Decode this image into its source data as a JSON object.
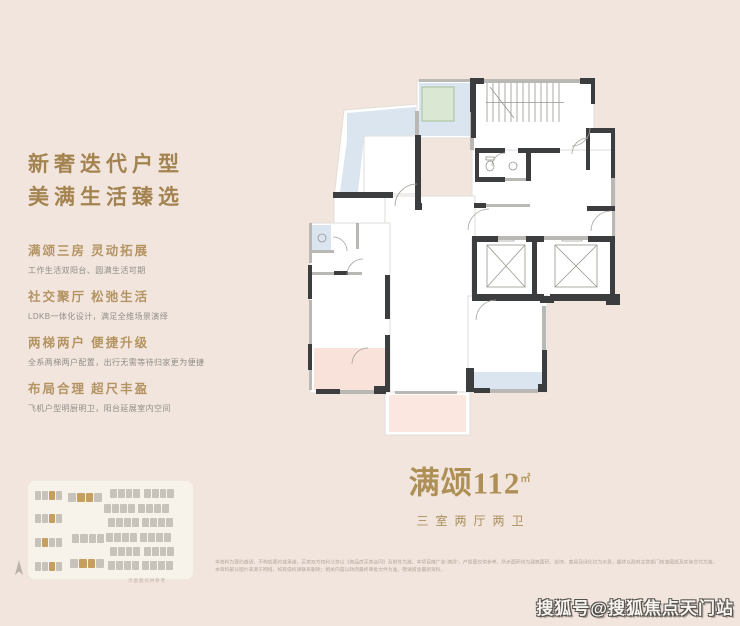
{
  "colors": {
    "background": "#f2e5dd",
    "accent_gold": "#a3834f",
    "heading_gold": "#b49463",
    "body_gray": "#8f8e89",
    "plan_wall_dark": "#3b3d3e",
    "plan_wall_gray": "#b9b8b5",
    "plan_balcony_blue": "#dbe5f0",
    "plan_equipment_green": "#dae8d3",
    "plan_bedroom_pink": "#f9e2da",
    "building_gray": "#c7c3ba",
    "building_gold": "#c59e60"
  },
  "left_panel": {
    "title_line1": "新奢迭代户型",
    "title_line2": "美满生活臻选",
    "sections": [
      {
        "heading": "满颂三房 灵动拓展",
        "body": "工作生活双阳台、圆满生活可期"
      },
      {
        "heading": "社交聚厅 松弛生活",
        "body": "LDKB一体化设计，满足全维场景演绎"
      },
      {
        "heading": "两梯两户 便捷升级",
        "body": "全系两梯两户配置，出行无需等待归家更为便捷"
      },
      {
        "heading": "布局合理 超尺丰盈",
        "body": "飞机户型明厨明卫，阳台延展室内空间"
      }
    ]
  },
  "unit_label": {
    "name": "满颂112",
    "unit": "㎡",
    "spec": "三室两厅两卫"
  },
  "site_plan": {
    "caption": "示意图仅供参考",
    "buildings": [
      {
        "x": 7,
        "y": 10,
        "w": 27,
        "gold": [
          2
        ]
      },
      {
        "x": 40,
        "y": 12,
        "w": 34,
        "gold": [
          1,
          2
        ]
      },
      {
        "x": 82,
        "y": 8,
        "w": 30,
        "gold": []
      },
      {
        "x": 116,
        "y": 8,
        "w": 30,
        "gold": []
      },
      {
        "x": 7,
        "y": 33,
        "w": 27,
        "gold": [
          2
        ]
      },
      {
        "x": 76,
        "y": 23,
        "w": 31,
        "gold": []
      },
      {
        "x": 110,
        "y": 23,
        "w": 31,
        "gold": []
      },
      {
        "x": 7,
        "y": 57,
        "w": 27,
        "gold": [
          1
        ]
      },
      {
        "x": 44,
        "y": 53,
        "w": 32,
        "gold": []
      },
      {
        "x": 80,
        "y": 37,
        "w": 31,
        "gold": []
      },
      {
        "x": 114,
        "y": 37,
        "w": 31,
        "gold": []
      },
      {
        "x": 78,
        "y": 52,
        "w": 31,
        "gold": []
      },
      {
        "x": 112,
        "y": 52,
        "w": 31,
        "gold": []
      },
      {
        "x": 7,
        "y": 81,
        "w": 27,
        "gold": [
          2
        ]
      },
      {
        "x": 42,
        "y": 78,
        "w": 34,
        "gold": [
          1,
          2
        ]
      },
      {
        "x": 82,
        "y": 66,
        "w": 30,
        "gold": []
      },
      {
        "x": 116,
        "y": 66,
        "w": 30,
        "gold": []
      },
      {
        "x": 80,
        "y": 80,
        "w": 31,
        "gold": []
      },
      {
        "x": 114,
        "y": 80,
        "w": 31,
        "gold": []
      }
    ]
  },
  "disclaimer": {
    "line1": "本资料为要约邀请，不构成要约或承诺，买卖双方权利义务以《商品房买卖合同》及附件为准。本项目推广名“满颂”，户型图仅供参考，所示面积均为建筑面积，装饰、家具及绿化仅为示意，最终以政府主管部门核准图纸及实际交付为准。",
    "line2": "本资料部分图片来源于网络，如有侵权请联系删除；相关内容以政府最终审批文件为准，敬请留意最新资料。"
  },
  "watermark": "搜狐号@搜狐焦点天门站"
}
